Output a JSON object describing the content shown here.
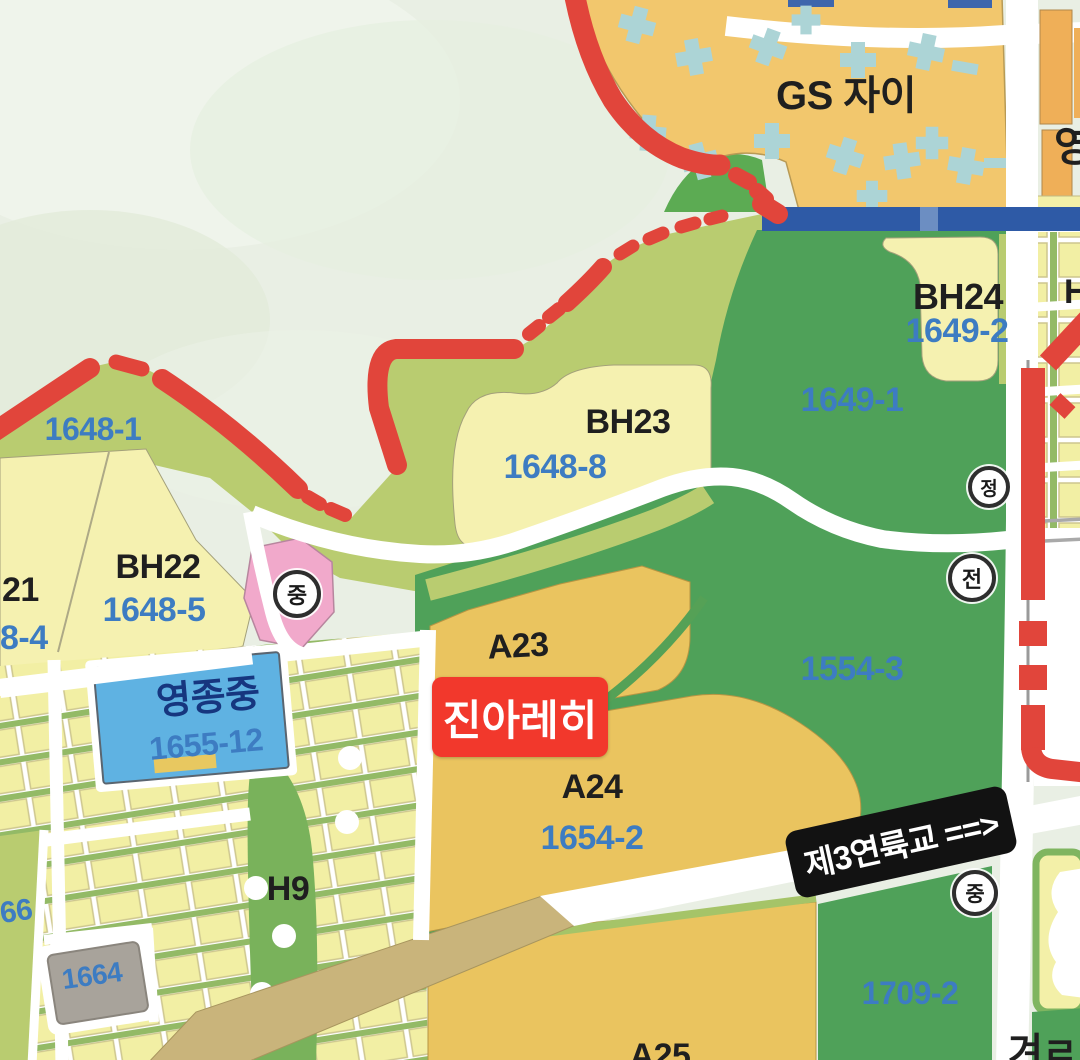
{
  "map": {
    "title": "Yeongjong development parcel map",
    "colors": {
      "sea": "#E9EFE4",
      "coastal_band": "#B9CC70",
      "dark_green": "#4FA159",
      "pale_parcel": "#F5F1B0",
      "mustard": "#EAC45F",
      "orange": "#F2C76D",
      "building_blue": "#ACD4D6",
      "parcel_blue": "#5FB2E2",
      "pink": "#F1A9CB",
      "purple": "#B28CAD",
      "gray_parcel": "#A8A39B",
      "tan_road": "#C9B47B",
      "red_line": "#E1453B",
      "blue_road": "#2E5AA6",
      "label_blue": "#3D7CC2",
      "label_black": "#1F1F1F",
      "label_navy": "#16367F"
    },
    "overlay_boxes": {
      "jina": {
        "text": "진아레히"
      },
      "bridge": {
        "text": "제3연륙교 ==>"
      }
    },
    "circle_icons": [
      {
        "id": "school-mid-west",
        "char": "중",
        "x": 297,
        "y": 594,
        "r": 20
      },
      {
        "id": "jeong-circle",
        "char": "정",
        "x": 989,
        "y": 487,
        "r": 17
      },
      {
        "id": "jeon-circle",
        "char": "전",
        "x": 972,
        "y": 578,
        "r": 20
      },
      {
        "id": "school-mid-south",
        "char": "중",
        "x": 975,
        "y": 893,
        "r": 19
      }
    ],
    "labels": [
      {
        "id": "gs-jai",
        "text": "GS 자이",
        "x": 846,
        "y": 96,
        "size": 40,
        "color": "black"
      },
      {
        "id": "yeong-partial",
        "text": "영",
        "x": 1054,
        "y": 147,
        "size": 42,
        "color": "black",
        "anchor": "left"
      },
      {
        "id": "bh24",
        "text": "BH24",
        "x": 958,
        "y": 297,
        "size": 36,
        "color": "black"
      },
      {
        "id": "num-1649-2",
        "text": "1649-2",
        "x": 957,
        "y": 331,
        "size": 34,
        "color": "blue"
      },
      {
        "id": "num-1649-1",
        "text": "1649-1",
        "x": 852,
        "y": 400,
        "size": 34,
        "color": "blue"
      },
      {
        "id": "h-partial",
        "text": "H",
        "x": 1064,
        "y": 292,
        "size": 34,
        "color": "black",
        "anchor": "left"
      },
      {
        "id": "num-1648-1",
        "text": "1648-1",
        "x": 93,
        "y": 429,
        "size": 32,
        "color": "blue"
      },
      {
        "id": "bh23",
        "text": "BH23",
        "x": 628,
        "y": 422,
        "size": 34,
        "color": "black"
      },
      {
        "id": "num-1648-8",
        "text": "1648-8",
        "x": 555,
        "y": 467,
        "size": 34,
        "color": "blue"
      },
      {
        "id": "bh21-partial",
        "text": "21",
        "x": 2,
        "y": 590,
        "size": 34,
        "color": "black",
        "anchor": "left"
      },
      {
        "id": "num-1648-4-part",
        "text": "8-4",
        "x": 0,
        "y": 638,
        "size": 34,
        "color": "blue",
        "anchor": "left"
      },
      {
        "id": "bh22",
        "text": "BH22",
        "x": 158,
        "y": 567,
        "size": 34,
        "color": "black"
      },
      {
        "id": "num-1648-5",
        "text": "1648-5",
        "x": 154,
        "y": 610,
        "size": 34,
        "color": "blue"
      },
      {
        "id": "yeongjong-mid",
        "text": "영종중",
        "x": 208,
        "y": 698,
        "size": 38,
        "color": "navy",
        "rot": -5
      },
      {
        "id": "num-1655-12",
        "text": "1655-12",
        "x": 206,
        "y": 744,
        "size": 32,
        "color": "blue",
        "rot": -5
      },
      {
        "id": "a23",
        "text": "A23",
        "x": 518,
        "y": 646,
        "size": 34,
        "color": "black",
        "rot": -3
      },
      {
        "id": "a24",
        "text": "A24",
        "x": 592,
        "y": 787,
        "size": 34,
        "color": "black"
      },
      {
        "id": "num-1654-2",
        "text": "1654-2",
        "x": 592,
        "y": 838,
        "size": 34,
        "color": "blue"
      },
      {
        "id": "num-1554-3",
        "text": "1554-3",
        "x": 852,
        "y": 669,
        "size": 34,
        "color": "blue"
      },
      {
        "id": "h9",
        "text": "H9",
        "x": 288,
        "y": 889,
        "size": 34,
        "color": "black"
      },
      {
        "id": "num-66-partial",
        "text": "66",
        "x": 0,
        "y": 912,
        "size": 30,
        "color": "blue",
        "rot": -8,
        "anchor": "left"
      },
      {
        "id": "num-1664",
        "text": "1664",
        "x": 92,
        "y": 976,
        "size": 28,
        "color": "blue",
        "rot": -8
      },
      {
        "id": "num-1709-2",
        "text": "1709-2",
        "x": 910,
        "y": 993,
        "size": 32,
        "color": "blue"
      },
      {
        "id": "a25-partial",
        "text": "A25",
        "x": 660,
        "y": 1056,
        "size": 34,
        "color": "black"
      },
      {
        "id": "br-partial",
        "text": "겨ㄹ",
        "x": 1008,
        "y": 1053,
        "size": 38,
        "color": "black",
        "anchor": "left"
      }
    ]
  }
}
